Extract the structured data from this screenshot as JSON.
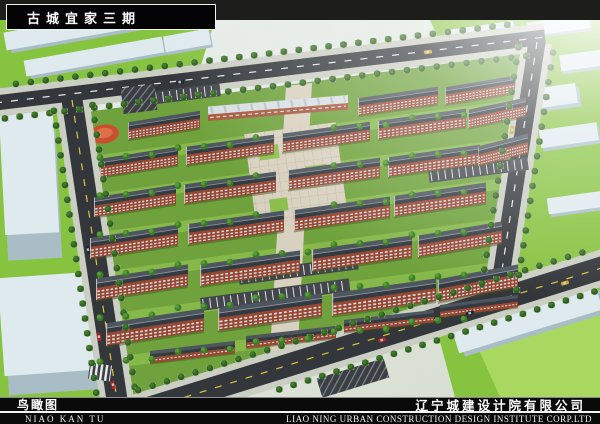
{
  "title_banner": {
    "text": "古城宜家三期"
  },
  "bottom_bar": {
    "caption_cn": "鸟瞰图",
    "caption_pinyin": "NIAO KAN TU",
    "company_cn": "辽宁城建设计院有限公司",
    "company_en": "LIAO NING URBAN CONSTRUCTION DESIGN INSTITUTE CORP.LTD"
  },
  "palette": {
    "band_bg": "#1d1d1b",
    "banner_bg": "#040404",
    "banner_text": "#ffffff",
    "roof": "#343a41",
    "roof_light": "#4d555e",
    "ridge": "#8d969f",
    "brick": "#9a4732",
    "window": "#d4e2ea",
    "lawn": "#6fa23c",
    "lawn_light": "#8cbf4e",
    "field": "#86c33f",
    "field_light": "#a8d85f",
    "road": "#33373b",
    "mark_yellow": "#d9c53e",
    "mark_white": "#e9ecee",
    "sidewalk": "#cbcec3",
    "paving": "#d9d1bf",
    "context_top": "#dfeaee",
    "context_side": "#a9bdc7",
    "tree": "#3e7b28",
    "tree_dark": "#2f5f1d",
    "playground": "#c8502e",
    "parking": "#43474c",
    "haze": "#f4f8f8"
  }
}
